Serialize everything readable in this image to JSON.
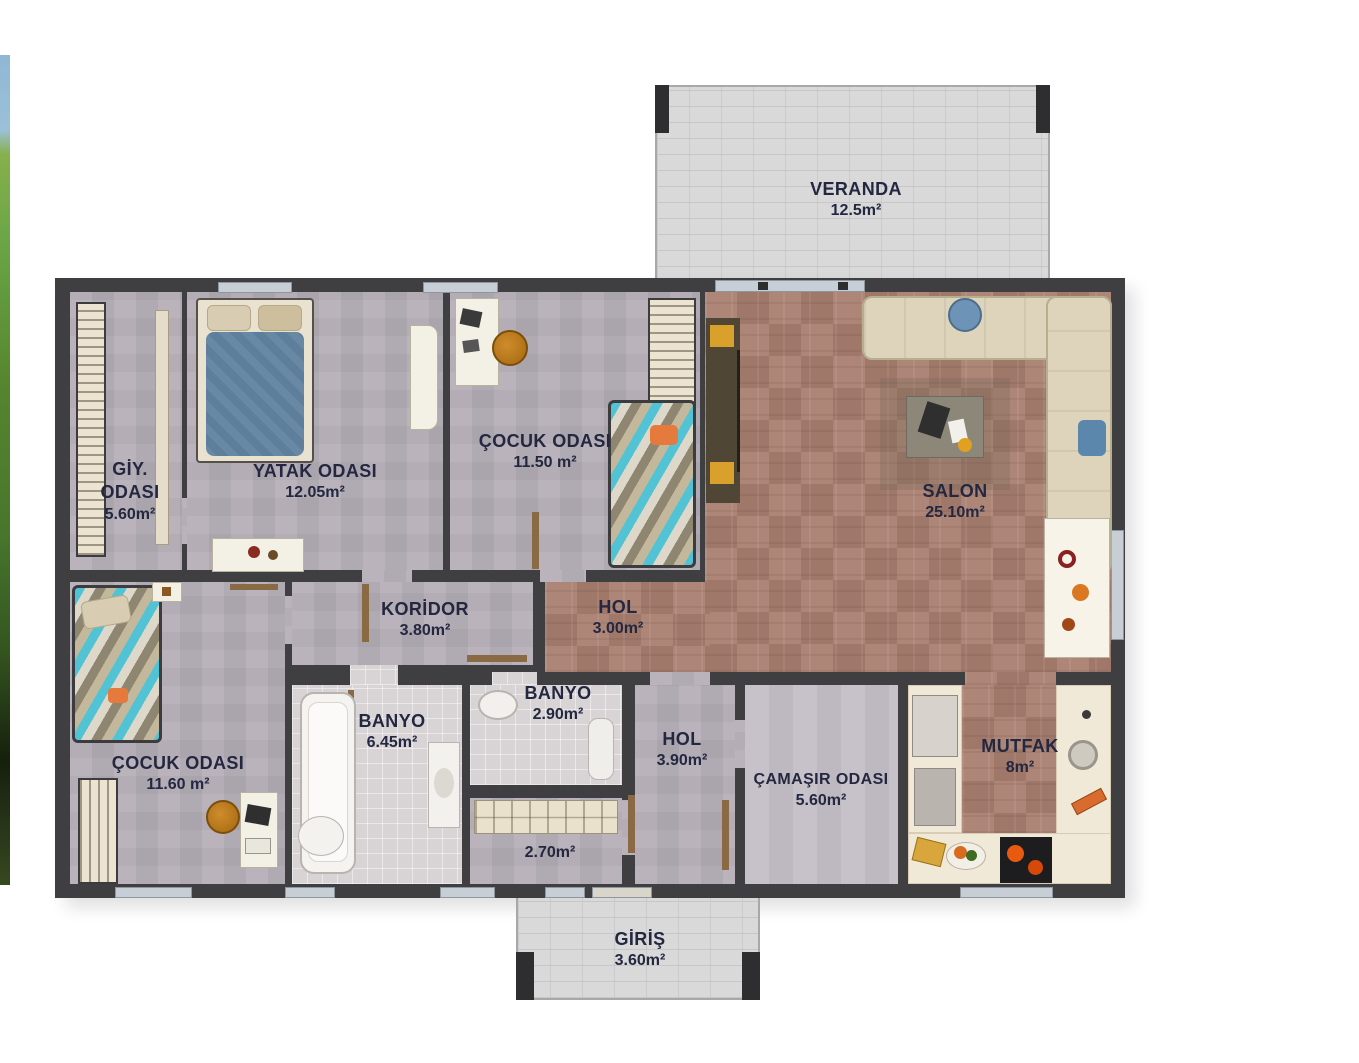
{
  "document": {
    "type": "floor-plan",
    "language": "tr"
  },
  "rooms": [
    {
      "id": "veranda",
      "name": "VERANDA",
      "area": "12.5m²"
    },
    {
      "id": "giy-odasi",
      "name": "GİY. ODASI",
      "area": "5.60m²"
    },
    {
      "id": "yatak-odasi",
      "name": "YATAK ODASI",
      "area": "12.05m²"
    },
    {
      "id": "cocuk-odasi-ust",
      "name": "ÇOCUK ODASI",
      "area": "11.50 m²"
    },
    {
      "id": "salon",
      "name": "SALON",
      "area": "25.10m²"
    },
    {
      "id": "koridor",
      "name": "KORİDOR",
      "area": "3.80m²"
    },
    {
      "id": "hol-ust",
      "name": "HOL",
      "area": "3.00m²"
    },
    {
      "id": "banyo-buyuk",
      "name": "BANYO",
      "area": "6.45m²"
    },
    {
      "id": "banyo-kucuk",
      "name": "BANYO",
      "area": "2.90m²"
    },
    {
      "id": "cocuk-odasi-alt",
      "name": "ÇOCUK ODASI",
      "area": "11.60 m²"
    },
    {
      "id": "hol-alt",
      "name": "HOL",
      "area": "3.90m²"
    },
    {
      "id": "camasir-odasi",
      "name": "ÇAMAŞIR ODASI",
      "area": "5.60m²"
    },
    {
      "id": "mutfak",
      "name": "MUTFAK",
      "area": "8m²"
    },
    {
      "id": "depo",
      "name": "",
      "area": "2.70m²"
    },
    {
      "id": "giris",
      "name": "GİRİŞ",
      "area": "3.60m²"
    }
  ],
  "palette": {
    "wall": "#3f3f41",
    "floor_bedroom": "#b3acb5",
    "floor_parquet": "#aa8070",
    "floor_tile": "#d8d4d5",
    "floor_stone": "#d9d9d9",
    "counter_cream": "#f1e9d7",
    "label_text": "#232740",
    "window": "#c7ced6",
    "door_wood": "#8a6a45"
  }
}
